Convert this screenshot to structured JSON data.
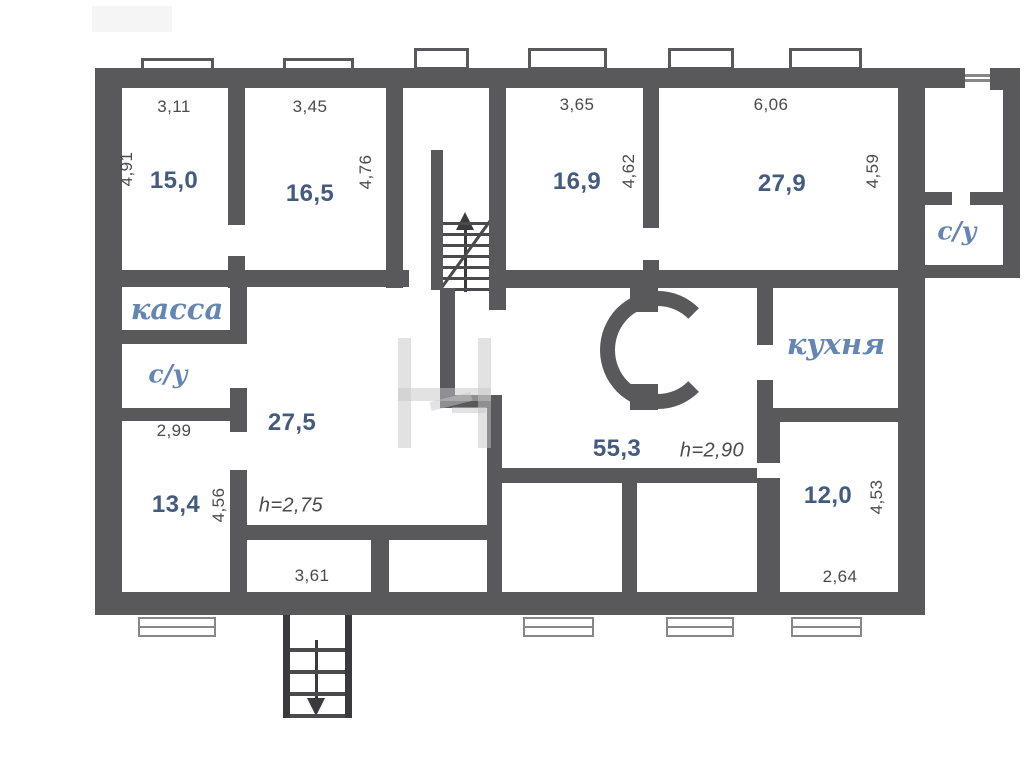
{
  "title": "Поэтажный план",
  "colors": {
    "wall": "#59595b",
    "area_label": "#445b80",
    "room_name": "#6585b2",
    "dimension": "#4b4b4d"
  },
  "rooms": {
    "r150": {
      "area": "15,0",
      "width": "3,11",
      "depth": "4,91"
    },
    "r165": {
      "area": "16,5",
      "width": "3,45",
      "depth": "4,76"
    },
    "r169": {
      "area": "16,9",
      "width": "3,65",
      "depth": "4,62"
    },
    "r279": {
      "area": "27,9",
      "width": "6,06",
      "depth": "4,59"
    },
    "kassa": {
      "name": "касса"
    },
    "su_left": {
      "name": "с/у"
    },
    "r134": {
      "area": "13,4",
      "width": "2,99",
      "depth": "4,56"
    },
    "r275": {
      "area": "27,5",
      "height": "h=2,75"
    },
    "vestibule": {
      "width": "3,61"
    },
    "hall": {
      "area": "55,3",
      "height": "h=2,90"
    },
    "kitchen": {
      "name": "кухня"
    },
    "su_right": {
      "name": "с/у"
    },
    "r120": {
      "area": "12,0",
      "width": "2,64",
      "depth": "4,53"
    }
  }
}
